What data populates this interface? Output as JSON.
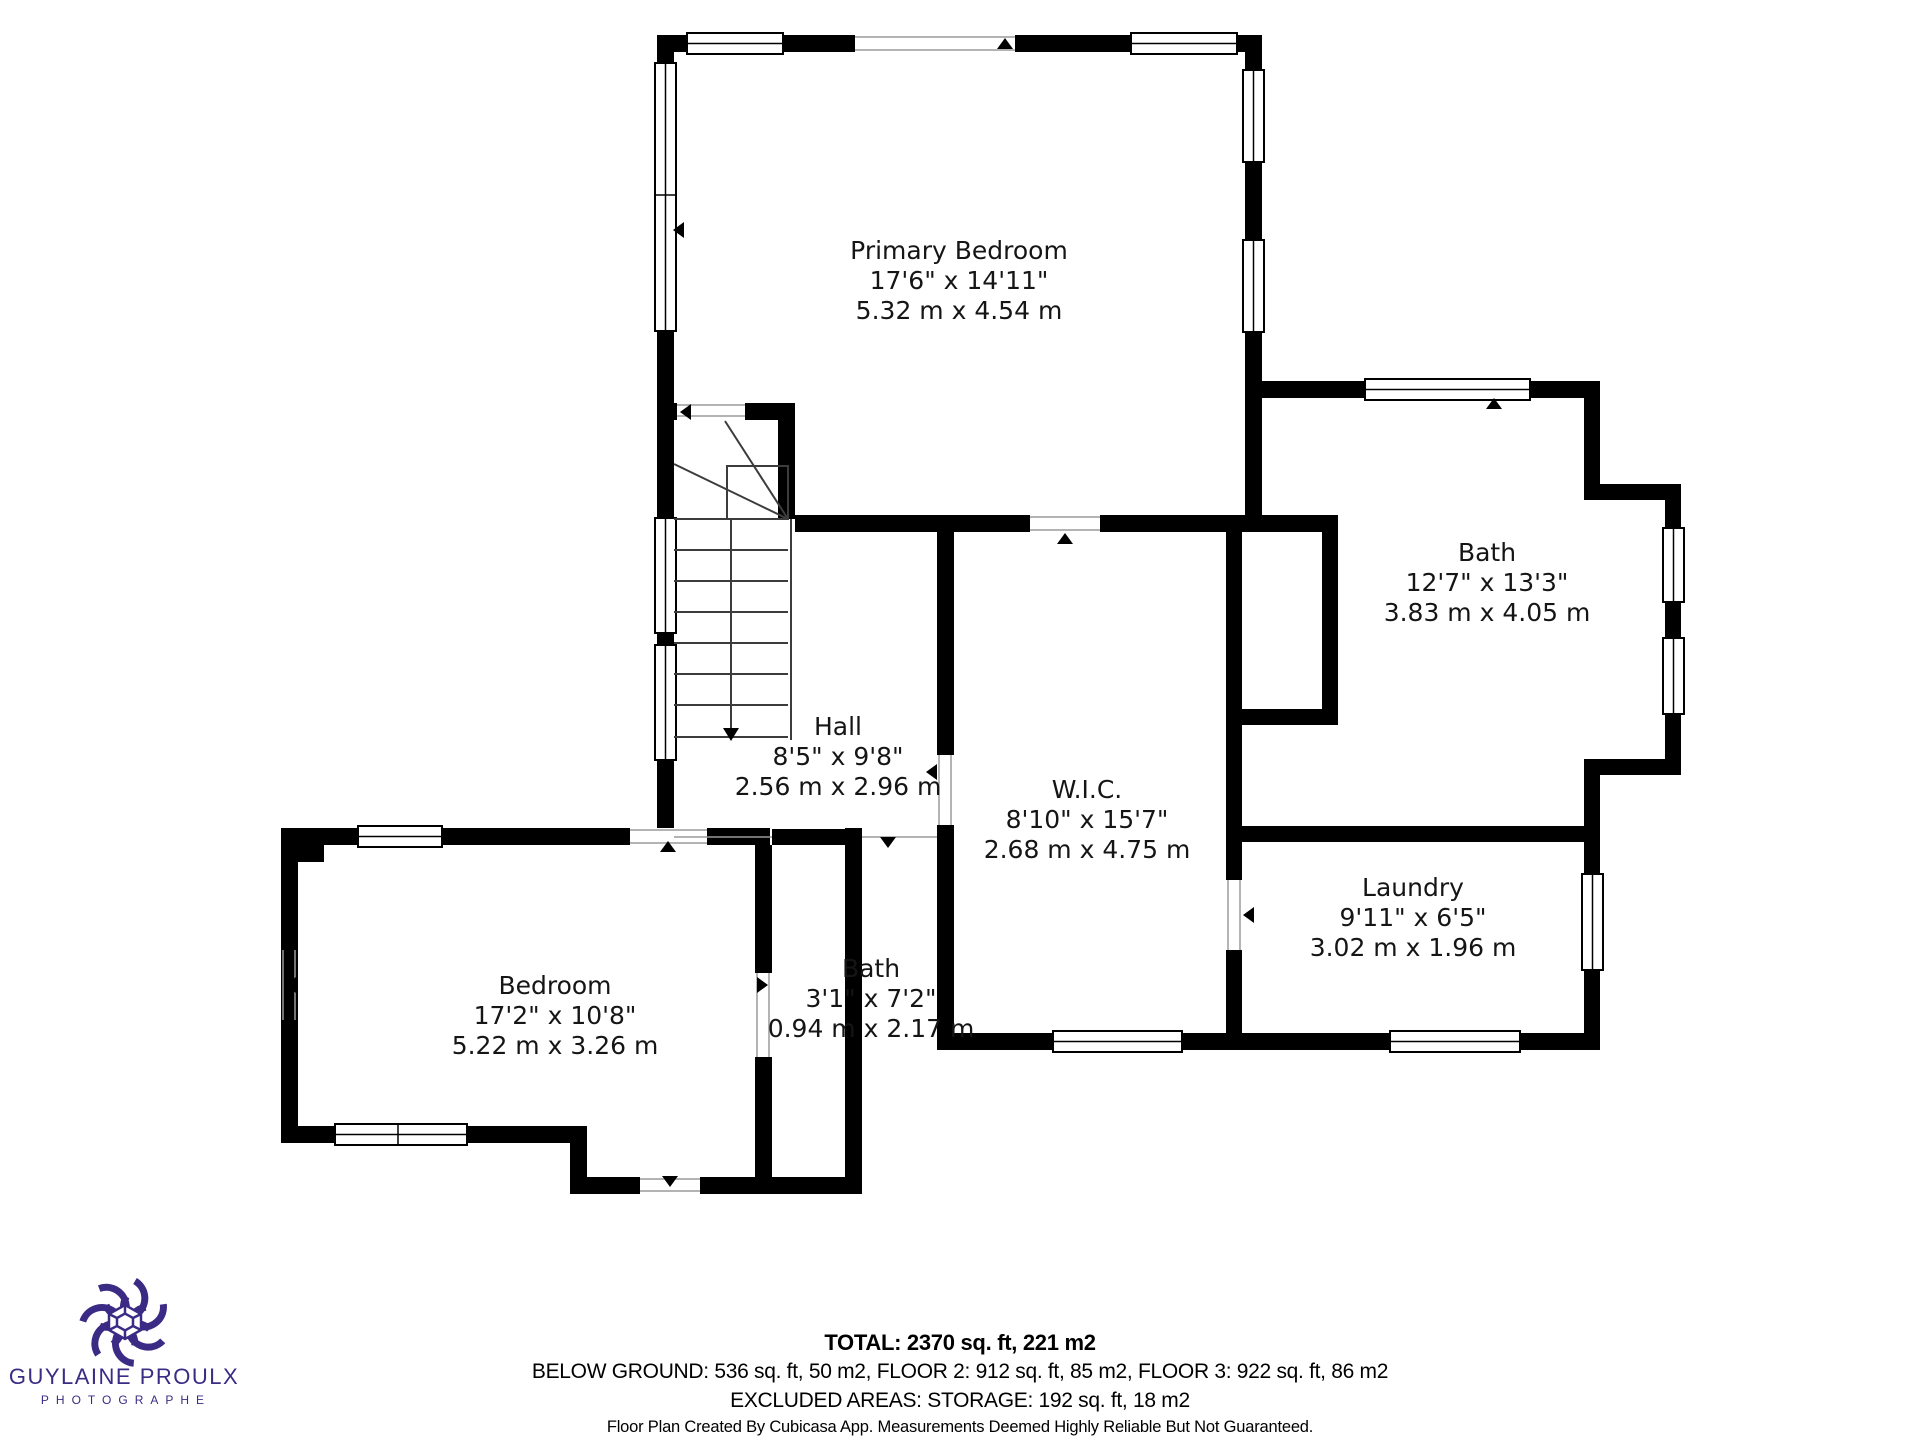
{
  "rooms": [
    {
      "name": "Primary Bedroom",
      "imperial": "17'6\" x 14'11\"",
      "metric": "5.32 m x 4.54 m"
    },
    {
      "name": "Bath",
      "imperial": "12'7\" x 13'3\"",
      "metric": "3.83 m x 4.05 m"
    },
    {
      "name": "Hall",
      "imperial": "8'5\" x 9'8\"",
      "metric": "2.56 m x 2.96 m"
    },
    {
      "name": "W.I.C.",
      "imperial": "8'10\" x 15'7\"",
      "metric": "2.68 m x 4.75 m"
    },
    {
      "name": "Laundry",
      "imperial": "9'11\" x 6'5\"",
      "metric": "3.02 m x 1.96 m"
    },
    {
      "name": "Bedroom",
      "imperial": "17'2\" x 10'8\"",
      "metric": "5.22 m x 3.26 m"
    },
    {
      "name": "Bath",
      "imperial": "3'1\" x 7'2\"",
      "metric": "0.94 m x 2.17 m"
    }
  ],
  "summary": {
    "total": "TOTAL: 2370 sq. ft, 221 m2",
    "floors": "BELOW GROUND: 536 sq. ft, 50 m2, FLOOR 2: 912 sq. ft, 85 m2, FLOOR 3: 922 sq. ft, 86 m2",
    "excluded": "EXCLUDED AREAS: STORAGE: 192 sq. ft, 18 m2"
  },
  "disclaimer": "Floor Plan Created By Cubicasa App. Measurements Deemed Highly Reliable But Not Guaranteed.",
  "logo": {
    "name": "GUYLAINE PROULX",
    "subtitle": "PHOTOGRAPHE",
    "color": "#3b2b85"
  }
}
